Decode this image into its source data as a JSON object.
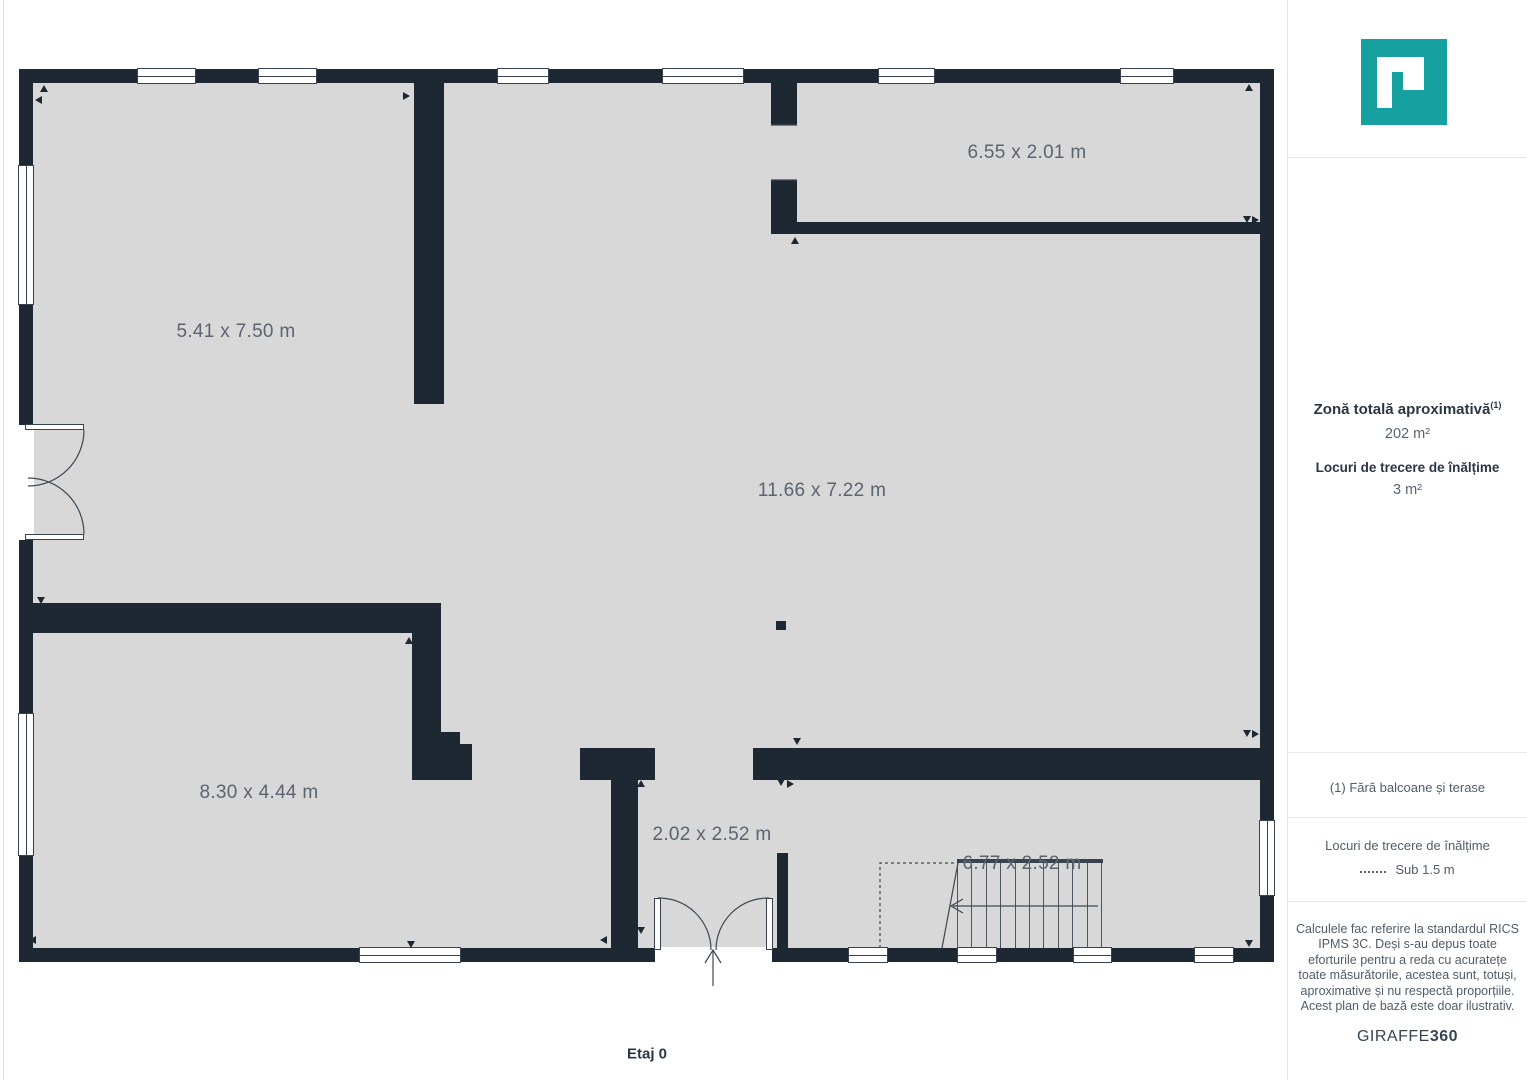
{
  "plan": {
    "floor_label": "Etaj 0",
    "colors": {
      "wall": "#1e2833",
      "floor": "#d8d8d8",
      "label_text": "#5b6471",
      "logo_teal": "#16a0a0"
    },
    "room_labels": [
      {
        "text": "5.41 x 7.50 m",
        "x": 236,
        "y": 332
      },
      {
        "text": "6.55 x 2.01 m",
        "x": 1027,
        "y": 153
      },
      {
        "text": "11.66 x 7.22 m",
        "x": 822,
        "y": 491
      },
      {
        "text": "8.30 x 4.44 m",
        "x": 259,
        "y": 793
      },
      {
        "text": "2.02 x 2.52 m",
        "x": 712,
        "y": 835
      },
      {
        "text": "6.77 x 2.52 m",
        "x": 1022,
        "y": 864
      }
    ],
    "walls": [
      {
        "x": 19,
        "y": 69,
        "w": 1255,
        "h": 14
      },
      {
        "x": 19,
        "y": 948,
        "w": 1255,
        "h": 14
      },
      {
        "x": 19,
        "y": 69,
        "w": 14,
        "h": 893
      },
      {
        "x": 1260,
        "y": 69,
        "w": 14,
        "h": 893
      },
      {
        "x": 414,
        "y": 83,
        "w": 30,
        "h": 321
      },
      {
        "x": 33,
        "y": 603,
        "w": 408,
        "h": 30
      },
      {
        "x": 412,
        "y": 633,
        "w": 29,
        "h": 147
      },
      {
        "x": 441,
        "y": 732,
        "w": 19,
        "h": 48
      },
      {
        "x": 460,
        "y": 744,
        "w": 12,
        "h": 36
      },
      {
        "x": 771,
        "y": 83,
        "w": 26,
        "h": 42
      },
      {
        "x": 771,
        "y": 180,
        "w": 26,
        "h": 54
      },
      {
        "x": 797,
        "y": 222,
        "w": 463,
        "h": 12
      },
      {
        "x": 580,
        "y": 748,
        "w": 75,
        "h": 32
      },
      {
        "x": 753,
        "y": 748,
        "w": 507,
        "h": 32
      },
      {
        "x": 611,
        "y": 780,
        "w": 27,
        "h": 168
      },
      {
        "x": 777,
        "y": 853,
        "w": 11,
        "h": 95
      },
      {
        "x": 776,
        "y": 621,
        "w": 10,
        "h": 9
      }
    ],
    "windows": [
      {
        "x": 137,
        "y": 68,
        "w": 59,
        "h": 16,
        "o": "h"
      },
      {
        "x": 258,
        "y": 68,
        "w": 59,
        "h": 16,
        "o": "h"
      },
      {
        "x": 497,
        "y": 68,
        "w": 52,
        "h": 16,
        "o": "h"
      },
      {
        "x": 662,
        "y": 68,
        "w": 82,
        "h": 16,
        "o": "h"
      },
      {
        "x": 878,
        "y": 68,
        "w": 57,
        "h": 16,
        "o": "h"
      },
      {
        "x": 1120,
        "y": 68,
        "w": 54,
        "h": 16,
        "o": "h"
      },
      {
        "x": 359,
        "y": 947,
        "w": 102,
        "h": 16,
        "o": "h"
      },
      {
        "x": 848,
        "y": 947,
        "w": 40,
        "h": 16,
        "o": "h"
      },
      {
        "x": 957,
        "y": 947,
        "w": 40,
        "h": 16,
        "o": "h"
      },
      {
        "x": 1073,
        "y": 947,
        "w": 39,
        "h": 16,
        "o": "h"
      },
      {
        "x": 1194,
        "y": 947,
        "w": 40,
        "h": 16,
        "o": "h"
      },
      {
        "x": 18,
        "y": 165,
        "w": 16,
        "h": 140,
        "o": "v"
      },
      {
        "x": 18,
        "y": 713,
        "w": 16,
        "h": 143,
        "o": "v"
      },
      {
        "x": 1259,
        "y": 820,
        "w": 16,
        "h": 76,
        "o": "v"
      }
    ],
    "door_gaps": [
      {
        "x": 18,
        "y": 425,
        "w": 16,
        "h": 115
      },
      {
        "x": 655,
        "y": 947,
        "w": 117,
        "h": 16
      }
    ],
    "door_leaves": [
      {
        "x": 25,
        "y": 424,
        "w": 59,
        "h": 6
      },
      {
        "x": 25,
        "y": 534,
        "w": 59,
        "h": 6
      },
      {
        "x": 654,
        "y": 898,
        "w": 7,
        "h": 52
      },
      {
        "x": 766,
        "y": 898,
        "w": 7,
        "h": 52
      }
    ],
    "stairs": {
      "x1": 957,
      "x2": 1101,
      "y1": 863,
      "y2": 948,
      "steps": 10,
      "top_bar": {
        "x": 957,
        "y": 859,
        "w": 146,
        "h": 4
      }
    },
    "markers": [
      {
        "x": 44,
        "y": 89,
        "d": "up"
      },
      {
        "x": 39,
        "y": 100,
        "d": "left"
      },
      {
        "x": 407,
        "y": 96,
        "d": "right"
      },
      {
        "x": 1249,
        "y": 88,
        "d": "up"
      },
      {
        "x": 795,
        "y": 241,
        "d": "up"
      },
      {
        "x": 1247,
        "y": 220,
        "d": "down"
      },
      {
        "x": 1256,
        "y": 220,
        "d": "right"
      },
      {
        "x": 41,
        "y": 601,
        "d": "down"
      },
      {
        "x": 409,
        "y": 641,
        "d": "up"
      },
      {
        "x": 446,
        "y": 736,
        "d": "left"
      },
      {
        "x": 1247,
        "y": 734,
        "d": "down"
      },
      {
        "x": 1256,
        "y": 734,
        "d": "right"
      },
      {
        "x": 641,
        "y": 784,
        "d": "up"
      },
      {
        "x": 797,
        "y": 742,
        "d": "down"
      },
      {
        "x": 781,
        "y": 783,
        "d": "down"
      },
      {
        "x": 791,
        "y": 784,
        "d": "right"
      },
      {
        "x": 604,
        "y": 940,
        "d": "left"
      },
      {
        "x": 641,
        "y": 931,
        "d": "down"
      },
      {
        "x": 33,
        "y": 940,
        "d": "left"
      },
      {
        "x": 411,
        "y": 945,
        "d": "down"
      },
      {
        "x": 1249,
        "y": 944,
        "d": "down"
      }
    ],
    "svg_paths": [
      {
        "name": "door-arc",
        "d": "M84,430 A56,56 0 0 1 28,486"
      },
      {
        "name": "door-arc",
        "d": "M84,534 A56,56 0 0 0 28,478"
      },
      {
        "name": "door-arc",
        "d": "M658,898 A52,52 0 0 1 711,950"
      },
      {
        "name": "door-arc",
        "d": "M769,898 A52,52 0 0 0 716,950"
      },
      {
        "name": "entrance-arrow",
        "d": "M705,963 L713,950 L721,963"
      },
      {
        "name": "entrance-arrow",
        "d": "M713,950 L713,986"
      },
      {
        "name": "stairs-direction-arrow",
        "d": "M1098,906 L953,906"
      },
      {
        "name": "stairs-direction-arrow",
        "d": "M963,899 L951,906 L963,913"
      },
      {
        "name": "stairs-direction-arrow",
        "d": "M958,863 L942,948"
      },
      {
        "name": "low-height-dashed-boundary",
        "d": "M880,948 L880,863 L957,863",
        "dash": "3,3"
      },
      {
        "name": "door-jamb-line",
        "d": "M771,125 L797,125"
      },
      {
        "name": "door-jamb-line",
        "d": "M771,180 L797,180"
      }
    ]
  },
  "sidebar": {
    "total_area_label": "Zonă totală aproximativă",
    "total_area_footnote_mark": "(1)",
    "total_area_value": "202 m²",
    "low_height_label": "Locuri de trecere de înălțime",
    "low_height_value": "3 m²",
    "footnote": "(1) Fără balcoane și terase",
    "legend_title": "Locuri de trecere de înălțime",
    "legend_value": "Sub 1.5 m",
    "disclaimer_lines": [
      "Calculele fac referire la standardul RICS",
      "IPMS 3C. Deși s-au depus toate",
      "eforturile pentru a reda cu acuratețe",
      "toate măsurătorile, acestea sunt, totuși,",
      "aproximative și nu respectă proporțiile.",
      "Acest plan de bază este doar ilustrativ."
    ],
    "brand_name": "GIRAFFE",
    "brand_suffix": "360"
  }
}
